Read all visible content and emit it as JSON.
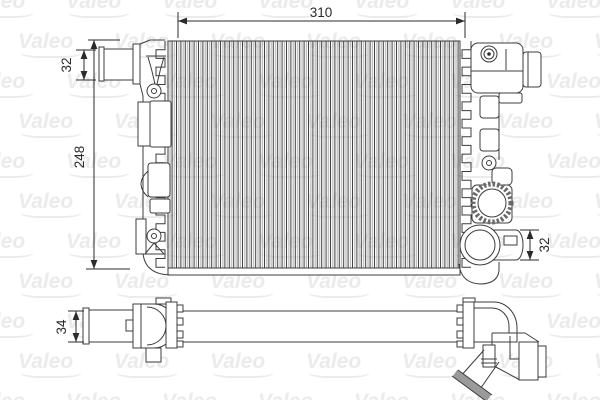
{
  "watermark": {
    "label": "Valeo"
  },
  "dimensions": {
    "core_width": "310",
    "inlet_pipe_diameter": "32",
    "core_height": "248",
    "outlet_pipe_diameter": "32",
    "side_profile_thickness": "34"
  },
  "colors": {
    "background": "#ffffff",
    "line": "#3c3c3c",
    "dimension_text": "#2b2b2b",
    "watermark": "#ebebeb",
    "fin_gray": "#bdbdbd"
  }
}
